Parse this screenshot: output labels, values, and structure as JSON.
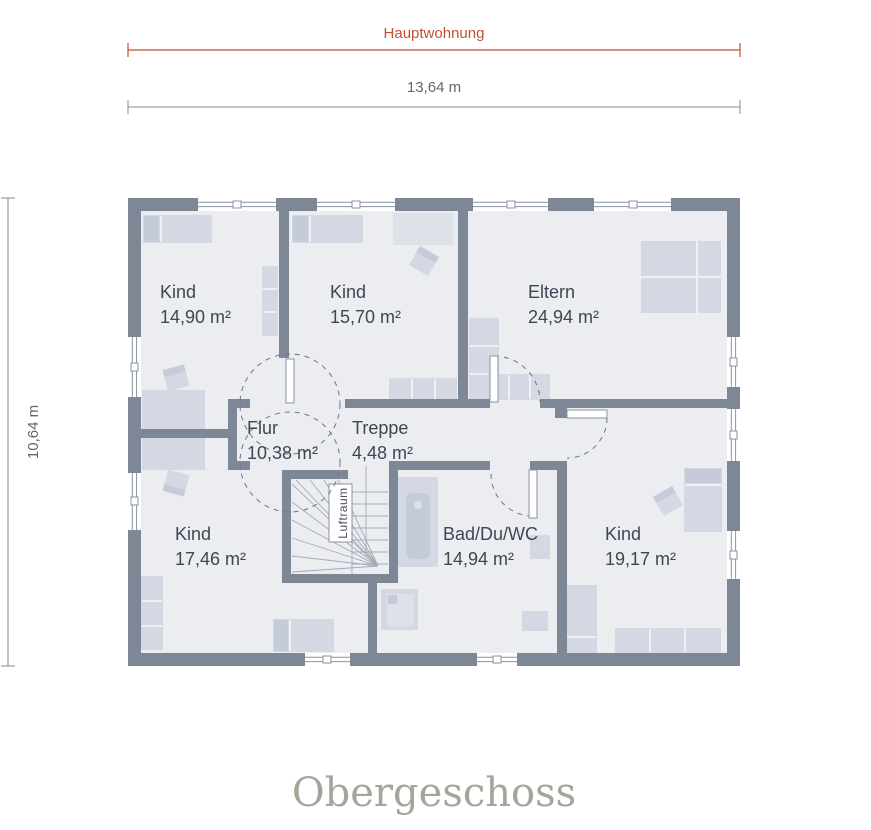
{
  "dimensions": {
    "zone": "Hauptwohnung",
    "width": "13,64 m",
    "height": "10,64 m"
  },
  "rooms": [
    {
      "name": "Kind",
      "area": "14,90 m²"
    },
    {
      "name": "Kind",
      "area": "15,70 m²"
    },
    {
      "name": "Eltern",
      "area": "24,94 m²"
    },
    {
      "name": "Flur",
      "area": "10,38 m²"
    },
    {
      "name": "Treppe",
      "area": "4,48 m²"
    },
    {
      "name": "Kind",
      "area": "17,46 m²"
    },
    {
      "name": "Bad/Du/WC",
      "area": "14,94 m²"
    },
    {
      "name": "Kind",
      "area": "19,17 m²"
    }
  ],
  "stair": {
    "label": "Luftraum"
  },
  "floor_title": "Obergeschoss",
  "colors": {
    "wall": "#7e8795",
    "floor": "#ecedf1",
    "accent": "#c1502f",
    "furniture": "#d3d8e2",
    "label": "#3e4654",
    "title": "#a7a49a"
  }
}
